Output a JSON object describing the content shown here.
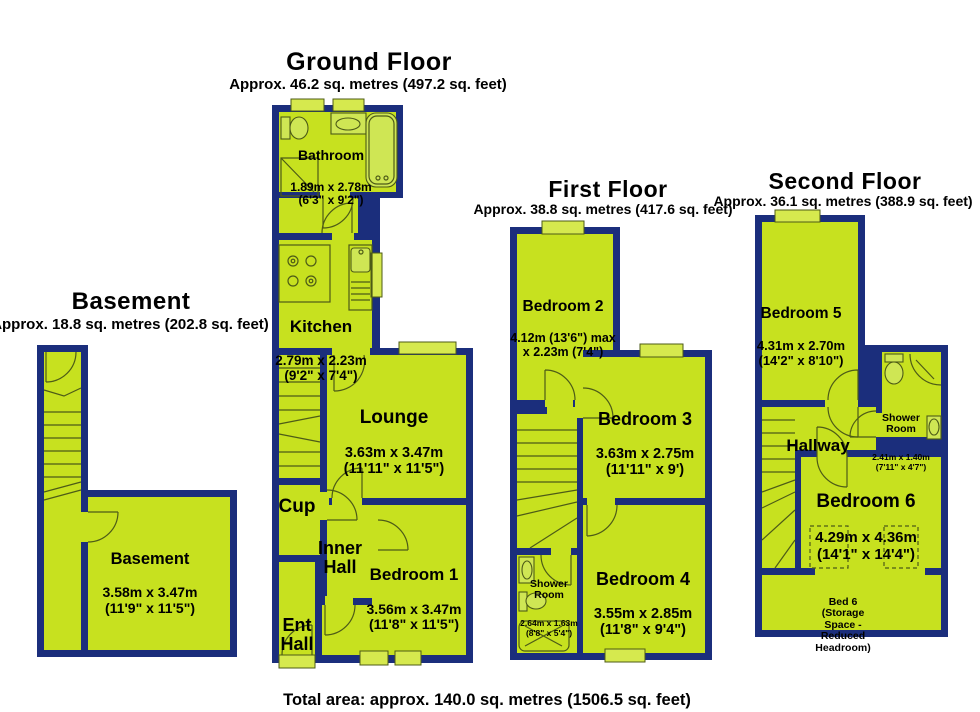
{
  "colors": {
    "wall": "#1b2e7c",
    "room": "#c7e11f",
    "window": "#d6e94e",
    "fixture": "#cfe654",
    "line": "#4d5b17"
  },
  "footer": {
    "total_area": "Total area: approx. 140.0 sq. metres (1506.5 sq. feet)"
  },
  "floors": {
    "basement": {
      "title": "Basement",
      "area": "Approx. 18.8 sq. metres (202.8 sq. feet)",
      "rooms": {
        "basement": {
          "name": "Basement",
          "dims": "3.58m x 3.47m\n(11'9\" x 11'5\")"
        }
      }
    },
    "ground": {
      "title": "Ground Floor",
      "area": "Approx. 46.2 sq. metres (497.2 sq. feet)",
      "rooms": {
        "bathroom": {
          "name": "Bathroom",
          "dims": "1.89m x 2.78m\n(6'3\" x 9'2\")"
        },
        "kitchen": {
          "name": "Kitchen",
          "dims": "2.79m x 2.23m\n(9'2\" x 7'4\")"
        },
        "lounge": {
          "name": "Lounge",
          "dims": "3.63m x 3.47m\n(11'11\" x 11'5\")"
        },
        "cup": {
          "name": "Cup"
        },
        "inner_hall": {
          "name": "Inner\nHall"
        },
        "bedroom1": {
          "name": "Bedroom 1",
          "dims": "3.56m x 3.47m\n(11'8\" x 11'5\")"
        },
        "ent_hall": {
          "name": "Ent\nHall"
        }
      }
    },
    "first": {
      "title": "First Floor",
      "area": "Approx. 38.8 sq. metres (417.6 sq. feet)",
      "rooms": {
        "bedroom2": {
          "name": "Bedroom 2",
          "dims": "4.12m (13'6\") max\nx 2.23m (7'4\")"
        },
        "bedroom3": {
          "name": "Bedroom 3",
          "dims": "3.63m x 2.75m\n(11'11\" x 9')"
        },
        "shower": {
          "name": "Shower\nRoom",
          "dims": "2.64m x 1.63m\n(8'8\" x 5'4\")"
        },
        "bedroom4": {
          "name": "Bedroom 4",
          "dims": "3.55m x 2.85m\n(11'8\" x 9'4\")"
        }
      }
    },
    "second": {
      "title": "Second Floor",
      "area": "Approx. 36.1 sq. metres (388.9 sq. feet)",
      "rooms": {
        "bedroom5": {
          "name": "Bedroom 5",
          "dims": "4.31m x 2.70m\n(14'2\" x 8'10\")"
        },
        "shower": {
          "name": "Shower\nRoom",
          "dims": "2.41m x 1.40m\n(7'11\" x 4'7\")"
        },
        "hallway": {
          "name": "Hallway"
        },
        "bedroom6": {
          "name": "Bedroom 6",
          "dims": "4.29m x 4.36m\n(14'1\" x 14'4\")"
        },
        "bed6_note": {
          "name": "Bed 6\n(Storage\nSpace -\nReduced\nHeadroom)"
        }
      }
    }
  }
}
